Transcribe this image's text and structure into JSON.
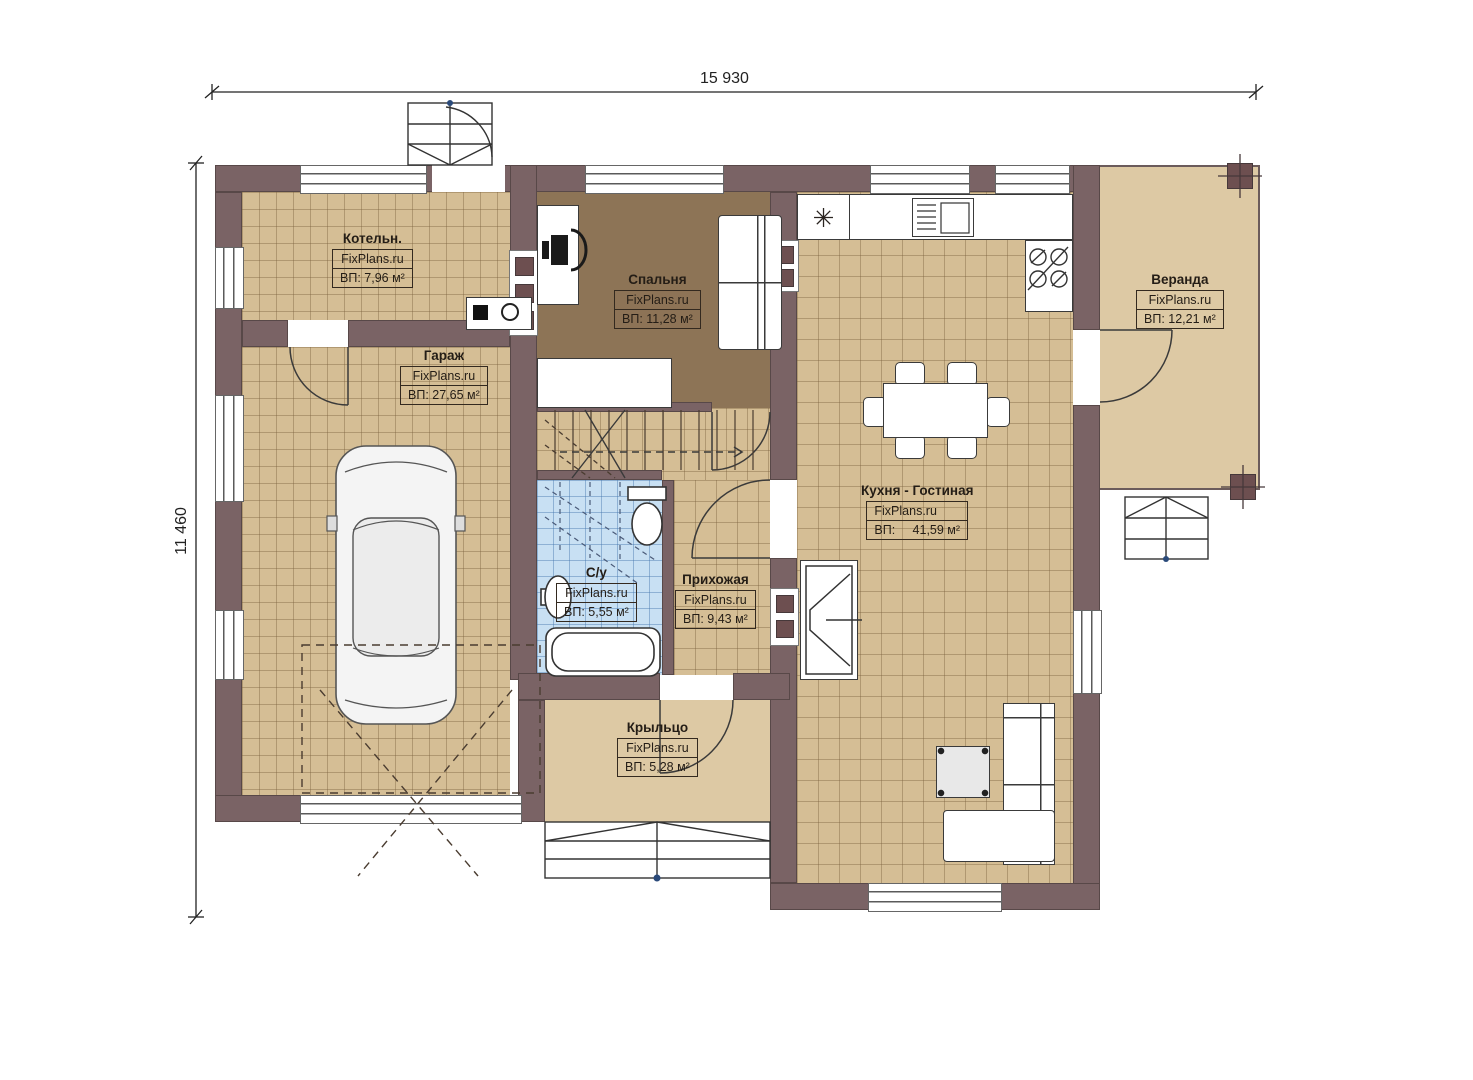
{
  "dimensions": {
    "width_label": "15 930",
    "height_label": "11 460"
  },
  "rooms": [
    {
      "name": "Котельн.",
      "brand": "FixPlans.ru",
      "area": "ВП: 7,96 м²"
    },
    {
      "name": "Гараж",
      "brand": "FixPlans.ru",
      "area": "ВП: 27,65 м²"
    },
    {
      "name": "Спальня",
      "brand": "FixPlans.ru",
      "area": "ВП: 11,28 м²"
    },
    {
      "name": "Кухня - Гостиная",
      "brand": "FixPlans.ru",
      "area": "ВП:     41,59 м²"
    },
    {
      "name": "Веранда",
      "brand": "FixPlans.ru",
      "area": "ВП: 12,21 м²"
    },
    {
      "name": "С/у",
      "brand": "FixPlans.ru",
      "area": "ВП: 5,55 м²"
    },
    {
      "name": "Прихожая",
      "brand": "FixPlans.ru",
      "area": "ВП: 9,43 м²"
    },
    {
      "name": "Крыльцо",
      "brand": "FixPlans.ru",
      "area": "ВП: 5,28 м²"
    }
  ],
  "icons": {
    "fridge": "✳"
  },
  "colors": {
    "wall": "#7a6365",
    "floor_tile": "#d5be95",
    "bedroom_floor": "#8d7456",
    "bathroom_tile": "#c8e0f3",
    "porch_floor": "#ddc9a4"
  }
}
